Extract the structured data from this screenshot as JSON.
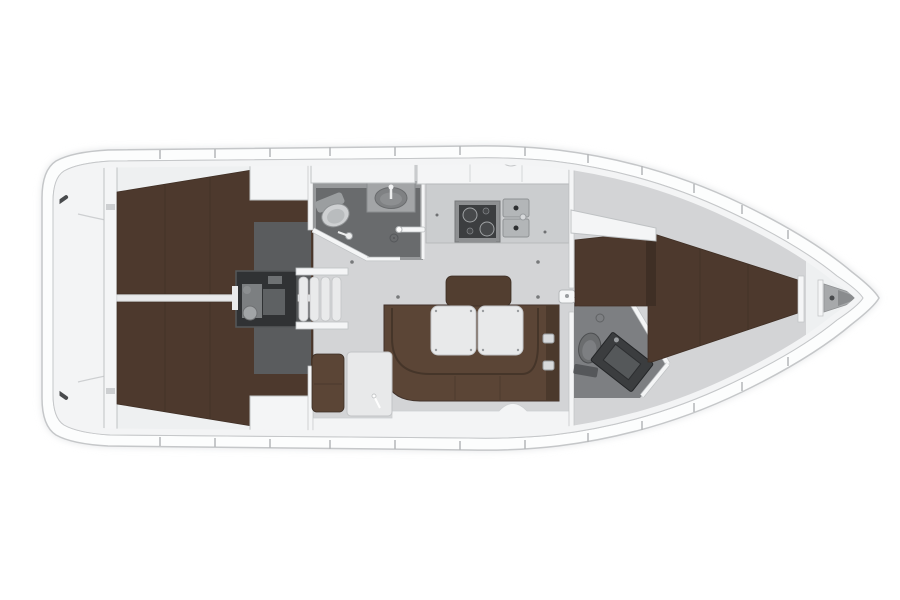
{
  "scene": {
    "name": "sailing-yacht-interior-floor-plan",
    "orientation": "bow-right-stern-left",
    "areas": [
      "swim-platform",
      "transom-bulkhead",
      "aft-cabin-port",
      "aft-cabin-starboard",
      "engine-compartment",
      "companionway-steps",
      "aft-head-bathroom",
      "galley",
      "salon",
      "nav-station",
      "forward-head-bathroom",
      "forward-cabin",
      "anchor-locker"
    ]
  },
  "colors": {
    "bg": "#ffffff",
    "hull_fill": "#fcfdfd",
    "hull_stroke": "#c5c7c9",
    "hull_shadow": "#dfe1e3",
    "deck_fill": "#eef0f1",
    "rim": "#f3f4f5",
    "floor": "#d3d4d6",
    "floor_dark": "#5a5c5e",
    "wall": "#f4f5f6",
    "wall_stroke": "#bfc2c4",
    "berth": "#4d392d",
    "berth_dark": "#3f2f25",
    "sofa": "#5b4536",
    "sofa_dark": "#4b392c",
    "backrest": "#523e30",
    "table": "#e8e9ea",
    "table_stroke": "#c2c4c6",
    "head_floor": "#97999b",
    "shower": "#696b6d",
    "fwd_head_floor": "#7d7f82",
    "fixture": "#ced0d2",
    "fixture_dark": "#9b9ea0",
    "engine": "#303234",
    "engine_part": "#7c7f81",
    "steps": "#e9eaeb",
    "counter": "#cbcdcf",
    "stove_frame": "#8e9092",
    "stove": "#3c3e40",
    "sink": "#b3b6b8",
    "vanity": "#3b3d3f",
    "vanity_basin": "#55585a",
    "anchor": "#a7a9ab",
    "anchor_shadow": "#8a8c8e",
    "tick": "#b5b7b9",
    "detail": "#494b4d",
    "line_soft": "#cdcfd1",
    "seam": "#3b2d24"
  }
}
